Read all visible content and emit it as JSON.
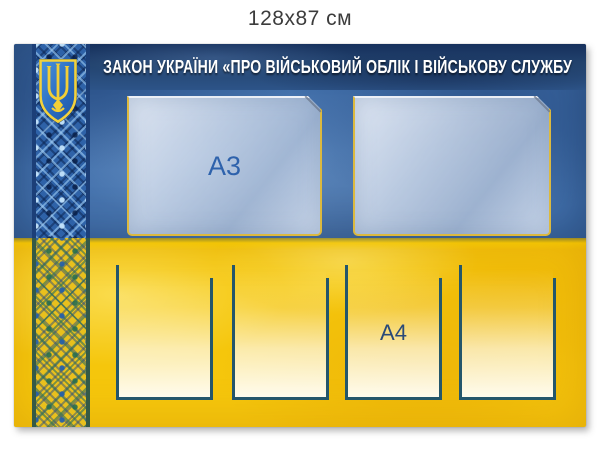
{
  "caption": "128x87 см",
  "board": {
    "title": "ЗАКОН УКРАЇНИ «ПРО ВІЙСЬКОВИЙ ОБЛІК І ВІЙСЬКОВУ СЛУЖБУ",
    "emblem_icon": "ukraine-trident-coat-of-arms",
    "ornament_icon": "vyshyvanka-embroidery-stripe",
    "a3_label": "А3",
    "a4_label": "А4",
    "a3_pocket_count": 2,
    "a4_pocket_count": 4,
    "colors": {
      "flag_blue": "#3e6ca8",
      "flag_yellow": "#f5c60c",
      "title_band_navy": "#16305c",
      "a3_pocket_border": "#dcb93f",
      "a4_pocket_border": "#24566b",
      "size_label_blue": "#2e62ac",
      "caption_gray": "#3c3c3c"
    }
  }
}
